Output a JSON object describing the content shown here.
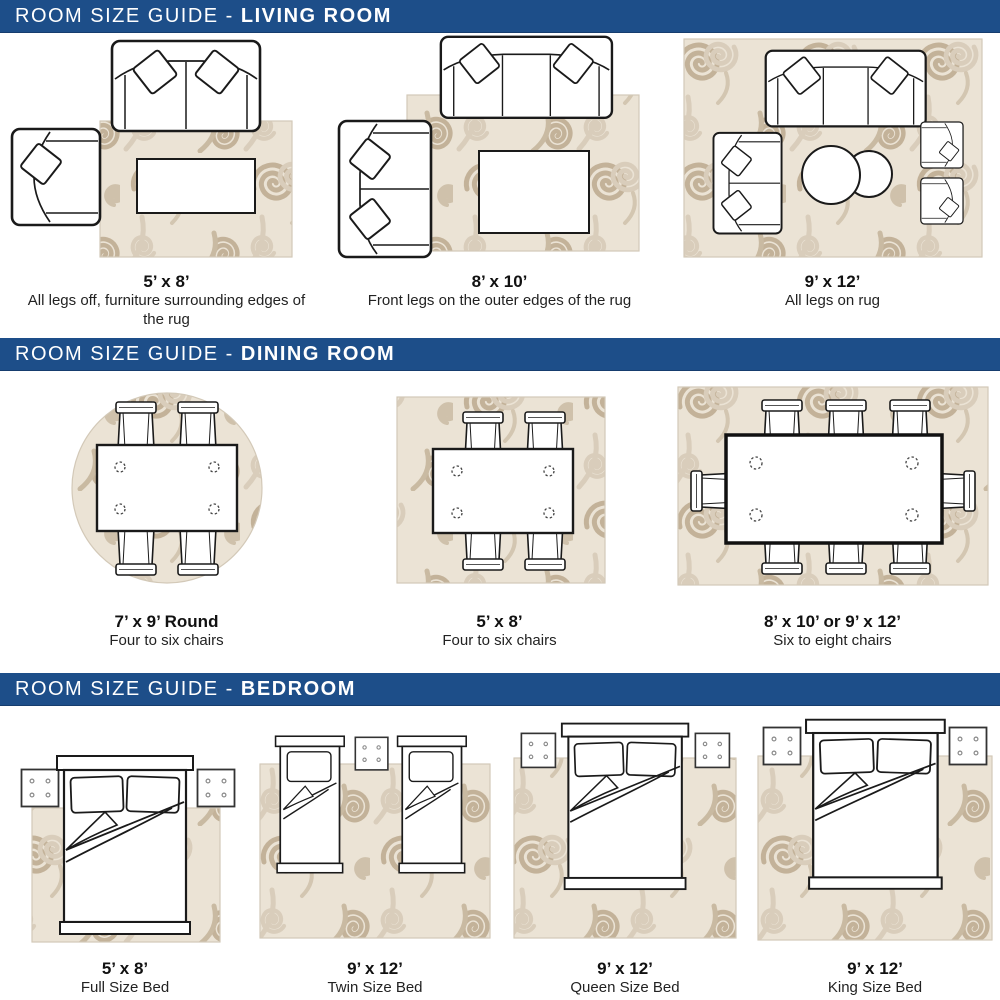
{
  "sections": [
    {
      "title_prefix": "ROOM SIZE GUIDE - ",
      "title_room": "LIVING ROOM",
      "panels": [
        {
          "size": "5’ x 8’",
          "desc": "All legs off, furniture surrounding edges of the rug"
        },
        {
          "size": "8’ x 10’",
          "desc": "Front legs on the outer edges of the rug"
        },
        {
          "size": "9’ x 12’",
          "desc": "All legs on rug"
        }
      ]
    },
    {
      "title_prefix": "ROOM SIZE GUIDE - ",
      "title_room": "DINING ROOM",
      "panels": [
        {
          "size": "7’ x 9’ Round",
          "desc": "Four to six chairs"
        },
        {
          "size": "5’ x 8’",
          "desc": "Four to six chairs"
        },
        {
          "size": "8’ x 10’ or 9’ x 12’",
          "desc": "Six to eight chairs"
        }
      ]
    },
    {
      "title_prefix": "ROOM SIZE GUIDE - ",
      "title_room": "BEDROOM",
      "panels": [
        {
          "size": "5’ x 8’",
          "desc": "Full Size Bed"
        },
        {
          "size": "9’ x 12’",
          "desc": "Twin Size Bed"
        },
        {
          "size": "9’ x 12’",
          "desc": "Queen Size Bed"
        },
        {
          "size": "9’ x 12’",
          "desc": "King Size Bed"
        }
      ]
    }
  ],
  "colors": {
    "header_bg": "#1d4e89",
    "header_text": "#ffffff",
    "rug_base": "#ebe3d5",
    "swirl_dark": "#c3b299",
    "swirl_light": "#d9cdbb",
    "furniture_line": "#1a1a1a",
    "furniture_fill": "#ffffff"
  }
}
